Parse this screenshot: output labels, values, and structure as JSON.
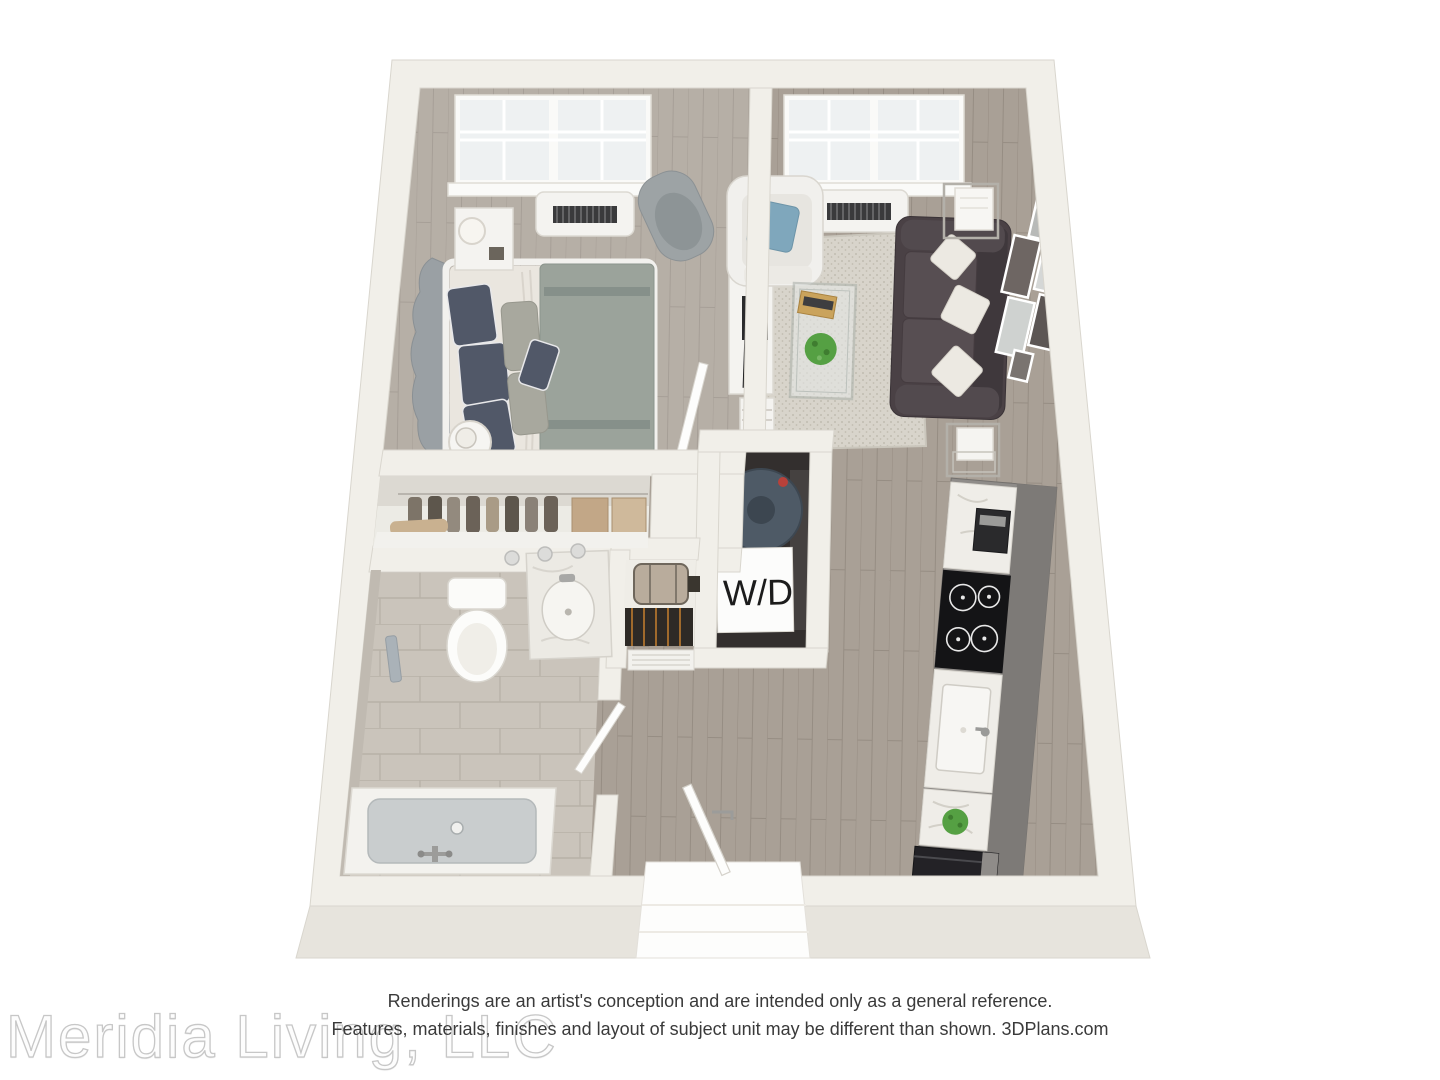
{
  "labels": {
    "washer_dryer": "W/D"
  },
  "disclaimer": {
    "line1": "Renderings are an artist's conception and are intended only as a general reference.",
    "line2": "Features, materials, finishes and layout of subject unit may be different than shown. 3DPlans.com"
  },
  "watermark": {
    "text": "Meridia Living, LLC"
  },
  "colors": {
    "wall": "#f1efe9",
    "wall_edge": "#d9d6ce",
    "wall_shade": "#e7e4dd",
    "floor_wood": "#a9a096",
    "floor_wood_line": "#968d83",
    "tile": "#cac4bb",
    "tile_line": "#b8b2a8",
    "rug": "#d8d4cb",
    "rug_dot": "#c1bcb1",
    "sofa": "#4a4145",
    "sofa_dark": "#3f383c",
    "sofa_seat": "#574e52",
    "pillow_white": "#ece9e2",
    "accent_blue": "#7fa7bc",
    "bed_mattress": "#eae6df",
    "bed_blanket": "#9ba39b",
    "blanket_stripe": "#86908a",
    "pillow_dark": "#515868",
    "pillow_sage": "#a8a89e",
    "chair_gray": "#9da3a5",
    "furniture_white": "#f4f3f0",
    "metal": "#b3b0a9",
    "plant": "#55a043",
    "cabinet": "#8f8c89",
    "cabinet_dark": "#7d7a77",
    "counter": "#efede8",
    "appliance_dark": "#232226",
    "tub": "#c9cdce",
    "closet_interior": "#ecebe5",
    "box_tan": "#c2a787",
    "clothes_dark": "#5d564c",
    "heater": "#4e5a66",
    "window_glass": "#eef1f2",
    "wd_box": "#fcfcfb",
    "wd_text": "#1c1c1c",
    "disclaimer_text": "#3a3a3a",
    "watermark_stroke": "#c7c7c7"
  }
}
